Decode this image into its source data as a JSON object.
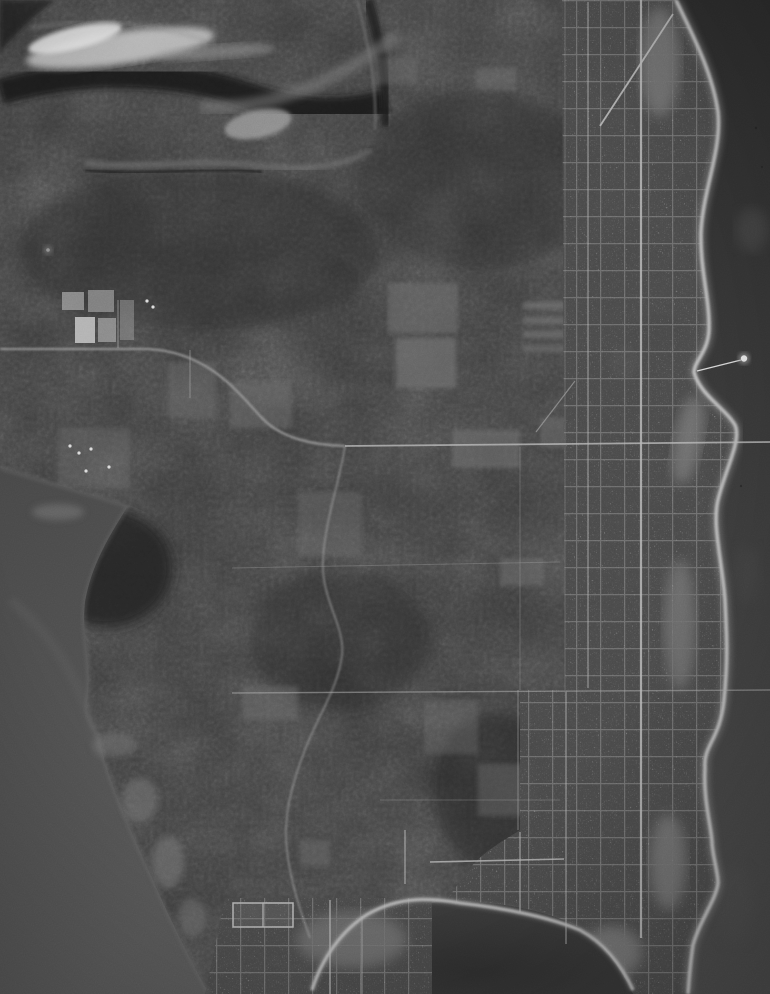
{
  "image": {
    "kind": "vintage-monochrome-aerial-photograph",
    "description": "Vertical aerial photo of a forested coastal peninsula. A street-grid town lines the scalloped east shore with a pier; interior is dark forest with farm clearings and rural roads; open water lies east, a lake west, and a bay at the south where the land narrows to a settled spit.",
    "width": 770,
    "height": 994
  },
  "palette": {
    "land_base": "#3a3a3a",
    "sea_top": "#2c2c2c",
    "sea_mid": "#3a3a3a",
    "sea_bottom": "#4b4b4b",
    "bay_center": "#2e2e2e",
    "bay_edge": "#3c3c3c",
    "lake_top": "#474747",
    "lake_bottom": "#585858",
    "beach": "#c2c2c2",
    "shore_glow": "#8d8d8d",
    "road": "#a8a8a8",
    "main_street": "#b6b6b6",
    "town_base": "#4b4b4b",
    "grid_line": "#a0a0a0",
    "clearing": "#6e6e6e",
    "dark_forest": "#232323",
    "streak": "#c6c6c6",
    "band": "#7a7a7a",
    "river": "#787878",
    "farm_field": "#9a9a9a",
    "house_dot": "#dcdcdc",
    "marsh": "#7a7a7a",
    "pier": "#d6d6d6",
    "pier_head": "#e6e6e6"
  },
  "features": {
    "sea": "open water east of town",
    "bay": "southern bay",
    "lake": "western lake and shoreline",
    "forest": "interior forest canopy",
    "town": "coastal street-grid town",
    "settlement_sw": "small settlement on southwest bay shore",
    "pier": "pier with round dock head",
    "beach": "bright shoreline beach",
    "clearings": "cleared fields and orchards",
    "farmstead": "farm plots with white buildings",
    "roads": "rural roads and section lines",
    "streak": "bright streak upper-left",
    "ravine": "winding ravine band northwest",
    "racetrack": "rectangular cleared track near bay"
  }
}
